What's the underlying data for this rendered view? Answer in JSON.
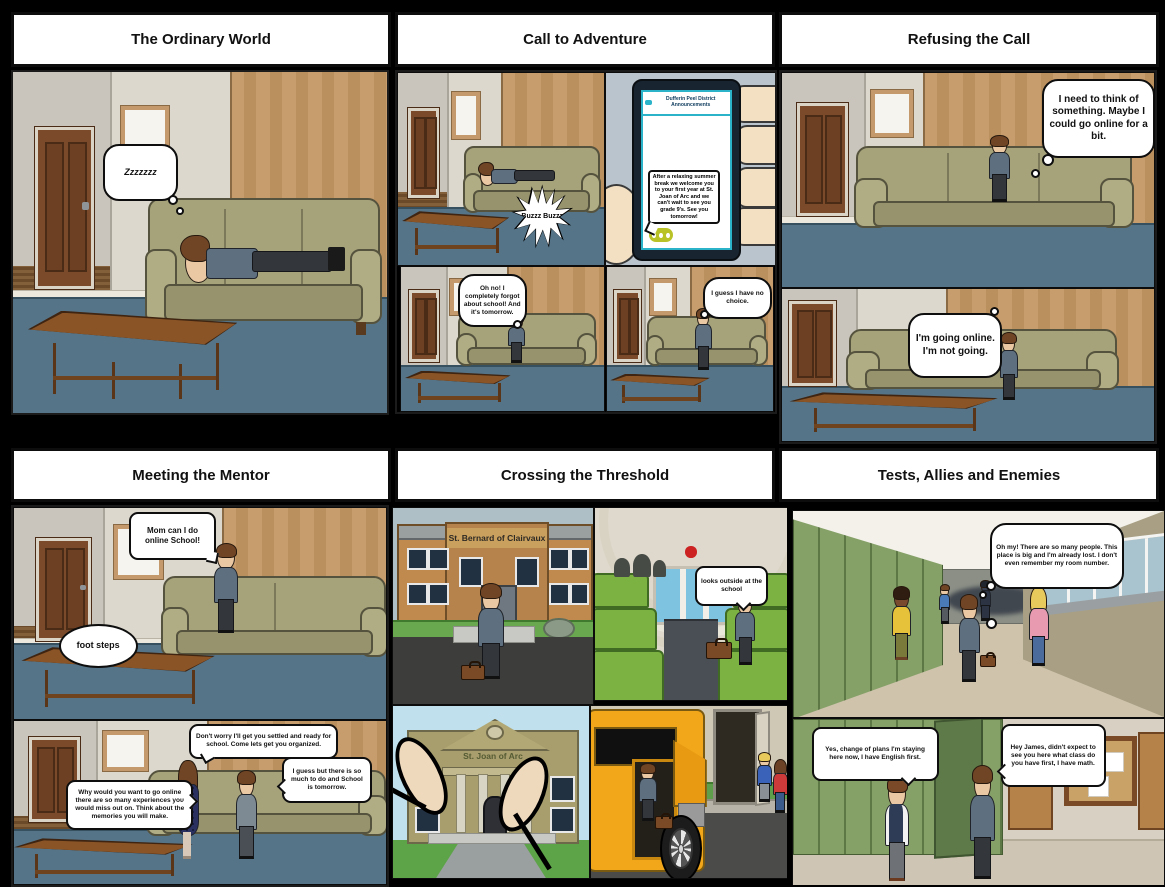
{
  "storyboard": {
    "panels": [
      {
        "title": "The Ordinary World",
        "bubbles": {
          "zzz": "Zzzzzzz"
        }
      },
      {
        "title": "Call to Adventure",
        "bubbles": {
          "buzz": "Buzzz Buzzz",
          "forgot": "Oh no! I completely forgot about school! And it's tomorrow.",
          "choice": "I guess I have no choice."
        },
        "phone": {
          "header": "Dufferin Peel District Announcements",
          "message": "After a relaxing summer break we welcome you to your first year at St. Joan of Arc and we can't wait to see you grade 9's. See you tomorrow!"
        }
      },
      {
        "title": "Refusing the Call",
        "bubbles": {
          "think": "I need to think of something. Maybe I could go online for a bit.",
          "going": "I'm going online. I'm not going."
        }
      },
      {
        "title": "Meeting the Mentor",
        "bubbles": {
          "ask": "Mom can I do online School!",
          "footsteps": "foot steps",
          "reply": "Don't worry I'll get you settled and ready for school. Come lets get you organized.",
          "guess": "I guess but there is so much to do and School is tomorrow.",
          "why": "Why would you want to go online there are so many experiences you would miss out on. Think about the memories you will make."
        }
      },
      {
        "title": "Crossing the Threshold",
        "signs": {
          "school1": "St. Bernard of Clairvaux",
          "school2": "St. Joan of Arc"
        },
        "bubbles": {
          "look": "looks outside at the school"
        }
      },
      {
        "title": "Tests, Allies and Enemies",
        "bubbles": {
          "lost": "Oh my! There are so many people. This place is big and I'm already lost. I don't even remember my room number.",
          "james": "Yes, change of plans I'm staying here now, I have English first.",
          "friend": "Hey James, didn't expect to see you here what class do you have first, I have math."
        }
      }
    ],
    "palette": {
      "floor_blue": "#567488",
      "couch_olive": "#a6a37b",
      "wood_panel": "#c49a6c",
      "locker_green": "#80985f",
      "bus_yellow": "#f2a71b",
      "seat_green": "#7cb241",
      "chat_icon_green": "#b9c327",
      "phone_teal": "#2ab3c9"
    }
  }
}
